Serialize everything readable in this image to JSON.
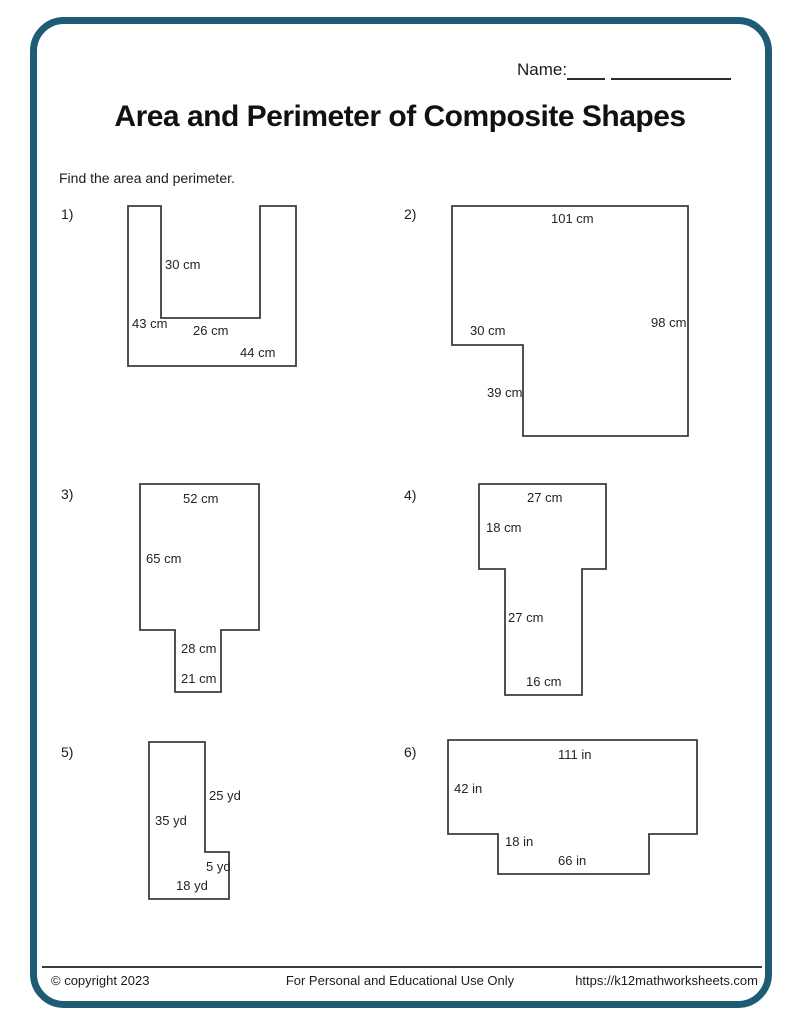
{
  "page": {
    "name_label": "Name:",
    "title": "Area and Perimeter of Composite Shapes",
    "instruction": "Find the area and perimeter.",
    "border_color": "#1d5c74",
    "footer": {
      "copyright": "© copyright 2023",
      "usage": "For Personal and Educational Use Only",
      "website": "https://k12mathworksheets.com"
    }
  },
  "problems": [
    {
      "number": "1)",
      "unit": "cm",
      "labels": [
        "30 cm",
        "43 cm",
        "26 cm",
        "44 cm"
      ]
    },
    {
      "number": "2)",
      "unit": "cm",
      "labels": [
        "101 cm",
        "98 cm",
        "30 cm",
        "39 cm"
      ]
    },
    {
      "number": "3)",
      "unit": "cm",
      "labels": [
        "52 cm",
        "65 cm",
        "28 cm",
        "21 cm"
      ]
    },
    {
      "number": "4)",
      "unit": "cm",
      "labels": [
        "27 cm",
        "18 cm",
        "27 cm",
        "16 cm"
      ]
    },
    {
      "number": "5)",
      "unit": "yd",
      "labels": [
        "25 yd",
        "35 yd",
        "5 yd",
        "18 yd"
      ]
    },
    {
      "number": "6)",
      "unit": "in",
      "labels": [
        "111 in",
        "42 in",
        "18 in",
        "66 in"
      ]
    }
  ]
}
